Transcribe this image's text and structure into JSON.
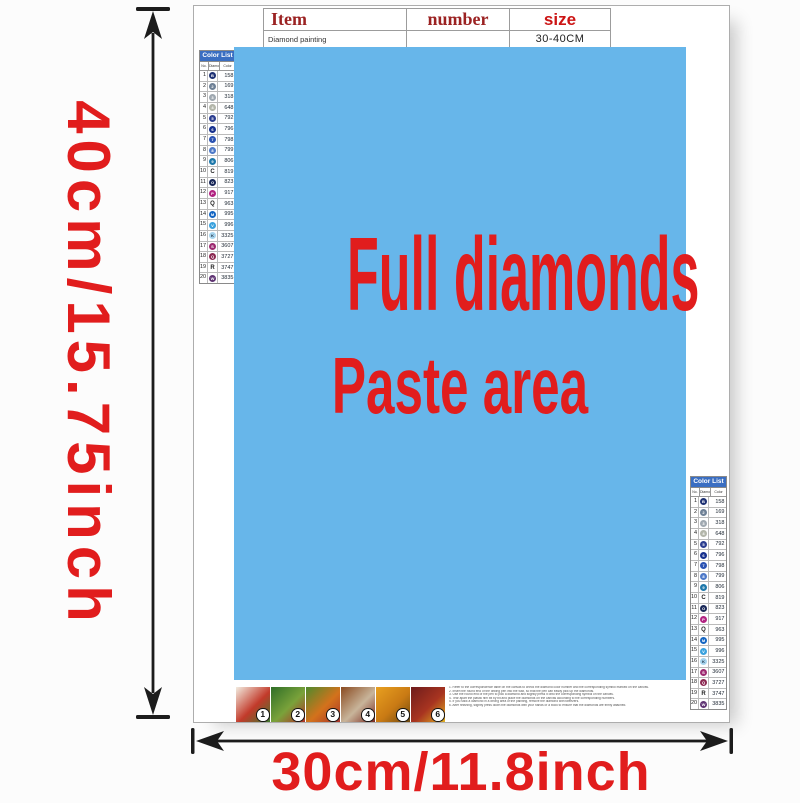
{
  "dimensions": {
    "height_label": "40cm/15.75inch",
    "width_label": "30cm/11.8inch"
  },
  "item_table": {
    "headers": [
      "Item",
      "number",
      "size"
    ],
    "product": "Diamond painting",
    "size_value": "30-40CM"
  },
  "paste_area": {
    "line1": "Full diamonds",
    "line2": "Paste area"
  },
  "color_list": {
    "title": "Color List",
    "columns": [
      "No.",
      "Diamond",
      "Color"
    ],
    "rows": [
      {
        "no": "1",
        "symbol": "B",
        "dot": "#1e3173",
        "code": "158"
      },
      {
        "no": "2",
        "symbol": "2",
        "dot": "#6f8196",
        "code": "169"
      },
      {
        "no": "3",
        "symbol": "3",
        "dot": "#9fa8b0",
        "code": "318"
      },
      {
        "no": "4",
        "symbol": "4",
        "dot": "#b3b6aa",
        "code": "648"
      },
      {
        "no": "5",
        "symbol": "5",
        "dot": "#2c3e90",
        "code": "792"
      },
      {
        "no": "6",
        "symbol": "6",
        "dot": "#17318e",
        "code": "796"
      },
      {
        "no": "7",
        "symbol": "7",
        "dot": "#2a52b2",
        "code": "798"
      },
      {
        "no": "8",
        "symbol": "8",
        "dot": "#4d79c8",
        "code": "799"
      },
      {
        "no": "9",
        "symbol": "9",
        "dot": "#1e78aa",
        "code": "806"
      },
      {
        "no": "10",
        "symbol": "C",
        "dot": null,
        "code": "819"
      },
      {
        "no": "11",
        "symbol": "O",
        "dot": "#182757",
        "code": "823"
      },
      {
        "no": "12",
        "symbol": "P",
        "dot": "#b12381",
        "code": "917"
      },
      {
        "no": "13",
        "symbol": "Q",
        "dot": null,
        "code": "963"
      },
      {
        "no": "14",
        "symbol": "M",
        "dot": "#1566c2",
        "code": "995"
      },
      {
        "no": "15",
        "symbol": "V",
        "dot": "#3ba2de",
        "code": "996"
      },
      {
        "no": "16",
        "symbol": "K",
        "dot": "#a6d4ee",
        "dark_symbol": true,
        "code": "3325"
      },
      {
        "no": "17",
        "symbol": "S",
        "dot": "#9d2a70",
        "code": "3607"
      },
      {
        "no": "18",
        "symbol": "Q",
        "dot": "#8c2a52",
        "code": "3727"
      },
      {
        "no": "19",
        "symbol": "R",
        "dot": null,
        "code": "3747"
      },
      {
        "no": "20",
        "symbol": "W",
        "dot": "#5f3473",
        "code": "3835"
      }
    ]
  },
  "steps": [
    {
      "number": "1",
      "colors": [
        "#f2ece0",
        "#c23a2a",
        "#3f7a2f"
      ]
    },
    {
      "number": "2",
      "colors": [
        "#2f6e27",
        "#7aa23a",
        "#b03026"
      ]
    },
    {
      "number": "3",
      "colors": [
        "#4f8a2d",
        "#d3721c",
        "#a8332a"
      ]
    },
    {
      "number": "4",
      "colors": [
        "#8a4a20",
        "#c8b49a",
        "#7a2a20"
      ]
    },
    {
      "number": "5",
      "colors": [
        "#e8a020",
        "#c97a14",
        "#6e4a10"
      ]
    },
    {
      "number": "6",
      "colors": [
        "#6e1c1c",
        "#a83420",
        "#e0b020"
      ]
    }
  ],
  "instructions": {
    "lines": [
      "1. Refer to the correspondence table on the canvas to check the diamond color number and the corresponding symbol marked on the canvas.",
      "2. Insert the round end of the drilling pen into the wax, so that the pen can easily pick up the diamonds.",
      "3. Use the round end of the pen to pick a diamond and slightly press it onto the corresponding symbol on the canvas.",
      "4. Tear apart the plastic film bit by bit and place the diamonds on the canvas according to the corresponding numbers.",
      "5. If you stick a diamond in a wrong area of the painting, remove the diamond with tweezers.",
      "6. After finishing, slightly press down the diamonds with your hands or a book to ensure that the diamonds are firmly attached."
    ]
  },
  "colors": {
    "paste_area_bg": "#67b6ea",
    "accent_red": "#e11d1d",
    "header_dark_red": "#9b2222",
    "size_red": "#cc1414",
    "list_header_bg": "#3a6ec2",
    "arrow_black": "#1c1c1c"
  }
}
